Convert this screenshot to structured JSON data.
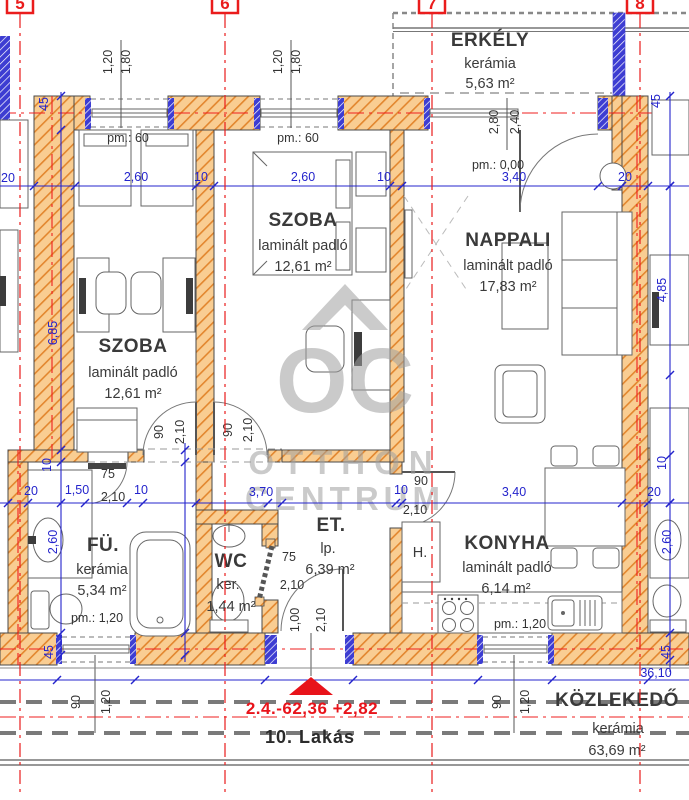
{
  "title": "10. Lakás",
  "grid_markers": [
    "5",
    "6",
    "7",
    "8"
  ],
  "rooms": {
    "erkely": {
      "name": "ERKÉLY",
      "floor": "kerámia",
      "area": "5,63 m²"
    },
    "szoba1": {
      "name": "SZOBA",
      "floor": "laminált padló",
      "area": "12,61 m²"
    },
    "szoba2": {
      "name": "SZOBA",
      "floor": "laminált padló",
      "area": "12,61 m²"
    },
    "nappali": {
      "name": "NAPPALI",
      "floor": "laminált padló",
      "area": "17,83 m²"
    },
    "furdo": {
      "name": "FÜ.",
      "floor": "kerámia",
      "area": "5,34 m²"
    },
    "wc": {
      "name": "WC",
      "floor": "ker.",
      "area": "1,44 m²"
    },
    "eloter": {
      "name": "ET.",
      "floor": "lp.",
      "area": "6,39 m²"
    },
    "konyha": {
      "name": "KONYHA",
      "floor": "laminált padló",
      "area": "6,14 m²"
    },
    "kozlekedo": {
      "name": "KÖZLEKEDŐ",
      "floor": "kerámia",
      "area": "63,69 m²"
    }
  },
  "labels": {
    "fridge": "H.",
    "elevation": "2.4.-62,36 +2,82",
    "apartment": "10. Lakás"
  },
  "watermark": {
    "logo": "OC",
    "line1": "OTTHON",
    "line2": "CENTRUM"
  },
  "colors": {
    "wall_orange": "#f9cd92",
    "hatch_orange": "#e2862e",
    "dim_blue": "#2424cc",
    "grid_red": "#ea1c1c",
    "jamb_blue": "#3d3dd2"
  },
  "dimensions": [
    {
      "t": "1,20",
      "x": 112,
      "y": 62,
      "r": 1,
      "c": "d"
    },
    {
      "t": "1,80",
      "x": 130,
      "y": 62,
      "r": 1,
      "c": "d"
    },
    {
      "t": "1,20",
      "x": 282,
      "y": 62,
      "r": 1,
      "c": "d"
    },
    {
      "t": "1,80",
      "x": 300,
      "y": 62,
      "r": 1,
      "c": "d"
    },
    {
      "t": "2,80",
      "x": 498,
      "y": 122,
      "r": 1,
      "c": "d"
    },
    {
      "t": "2,40",
      "x": 519,
      "y": 122,
      "r": 1,
      "c": "d"
    },
    {
      "t": "pm.: 60",
      "x": 128,
      "y": 142,
      "c": "d"
    },
    {
      "t": "pm.: 60",
      "x": 298,
      "y": 142,
      "c": "d"
    },
    {
      "t": "pm.: 0,00",
      "x": 498,
      "y": 169,
      "c": "d"
    },
    {
      "t": "pm.: 1,20",
      "x": 97,
      "y": 622,
      "c": "d"
    },
    {
      "t": "pm.: 1,20",
      "x": 520,
      "y": 628,
      "c": "d"
    },
    {
      "t": "20",
      "x": 8,
      "y": 182,
      "c": "b"
    },
    {
      "t": "45",
      "x": 48,
      "y": 104,
      "r": 1,
      "c": "b"
    },
    {
      "t": "2,60",
      "x": 136,
      "y": 181,
      "c": "b"
    },
    {
      "t": "10",
      "x": 201,
      "y": 181,
      "c": "b"
    },
    {
      "t": "2,60",
      "x": 303,
      "y": 181,
      "c": "b"
    },
    {
      "t": "10",
      "x": 384,
      "y": 181,
      "c": "b"
    },
    {
      "t": "3,40",
      "x": 514,
      "y": 181,
      "c": "b"
    },
    {
      "t": "20",
      "x": 625,
      "y": 181,
      "c": "b"
    },
    {
      "t": "45",
      "x": 660,
      "y": 101,
      "r": 1,
      "c": "b"
    },
    {
      "t": "6,85",
      "x": 57,
      "y": 333,
      "r": 1,
      "c": "b"
    },
    {
      "t": "4,85",
      "x": 666,
      "y": 290,
      "r": 1,
      "c": "b"
    },
    {
      "t": "20",
      "x": 31,
      "y": 495,
      "c": "b"
    },
    {
      "t": "1,50",
      "x": 77,
      "y": 494,
      "c": "b"
    },
    {
      "t": "10",
      "x": 141,
      "y": 494,
      "c": "b"
    },
    {
      "t": "3,70",
      "x": 261,
      "y": 496,
      "c": "b"
    },
    {
      "t": "10",
      "x": 401,
      "y": 494,
      "c": "b"
    },
    {
      "t": "3,40",
      "x": 514,
      "y": 496,
      "c": "b"
    },
    {
      "t": "20",
      "x": 654,
      "y": 496,
      "c": "b"
    },
    {
      "t": "10",
      "x": 51,
      "y": 465,
      "r": 1,
      "c": "b"
    },
    {
      "t": "2,60",
      "x": 57,
      "y": 542,
      "r": 1,
      "c": "b"
    },
    {
      "t": "45",
      "x": 53,
      "y": 652,
      "r": 1,
      "c": "b"
    },
    {
      "t": "10",
      "x": 666,
      "y": 463,
      "r": 1,
      "c": "b"
    },
    {
      "t": "2,60",
      "x": 671,
      "y": 542,
      "r": 1,
      "c": "b"
    },
    {
      "t": "45",
      "x": 670,
      "y": 652,
      "r": 1,
      "c": "b"
    },
    {
      "t": "36,10",
      "x": 656,
      "y": 677,
      "c": "b"
    },
    {
      "t": "75",
      "x": 108,
      "y": 478,
      "c": "d"
    },
    {
      "t": "2,10",
      "x": 113,
      "y": 501,
      "c": "d"
    },
    {
      "t": "90",
      "x": 163,
      "y": 432,
      "r": 1,
      "c": "d"
    },
    {
      "t": "2,10",
      "x": 184,
      "y": 432,
      "r": 1,
      "c": "d"
    },
    {
      "t": "90",
      "x": 232,
      "y": 430,
      "r": 1,
      "c": "d"
    },
    {
      "t": "2,10",
      "x": 252,
      "y": 430,
      "r": 1,
      "c": "d"
    },
    {
      "t": "90",
      "x": 421,
      "y": 485,
      "c": "d"
    },
    {
      "t": "2,10",
      "x": 415,
      "y": 514,
      "c": "d"
    },
    {
      "t": "75",
      "x": 289,
      "y": 561,
      "c": "d"
    },
    {
      "t": "2,10",
      "x": 292,
      "y": 589,
      "c": "d"
    },
    {
      "t": "1,00",
      "x": 299,
      "y": 620,
      "r": 1,
      "c": "d"
    },
    {
      "t": "2,10",
      "x": 325,
      "y": 620,
      "r": 1,
      "c": "d"
    },
    {
      "t": "90",
      "x": 80,
      "y": 702,
      "r": 1,
      "c": "d"
    },
    {
      "t": "1,20",
      "x": 110,
      "y": 702,
      "r": 1,
      "c": "d"
    },
    {
      "t": "90",
      "x": 501,
      "y": 702,
      "r": 1,
      "c": "d"
    },
    {
      "t": "1,20",
      "x": 529,
      "y": 702,
      "r": 1,
      "c": "d"
    }
  ]
}
